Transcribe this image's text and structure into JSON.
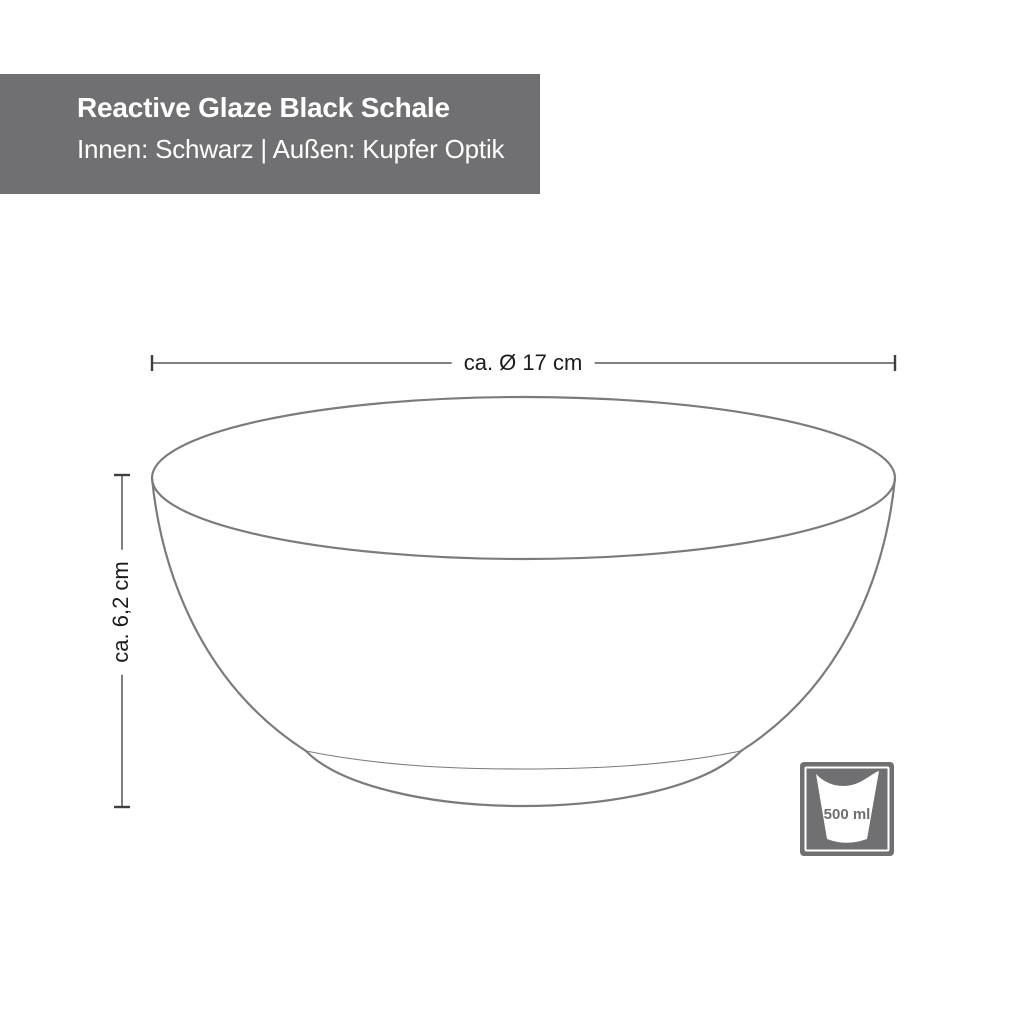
{
  "window": {
    "background": "#ffffff"
  },
  "header": {
    "title": "Reactive Glaze Black Schale",
    "subtitle": "Innen: Schwarz | Außen: Kupfer Optik",
    "bg_color": "#707072",
    "text_color": "#ffffff"
  },
  "drawing": {
    "subject": "bowl-side-view-technical-drawing",
    "outline_color": "#7b7b7f",
    "dimension_line_color": "#6f6f6f",
    "dimension_tick_color": "#3f3f3f",
    "dimension_text_color": "#1c1c1c",
    "diameter_label": "ca. Ø 17 cm",
    "height_label": "ca. 6,2 cm"
  },
  "capacity_badge": {
    "label": "500 ml",
    "bg_color": "#707072",
    "cup_color": "#ffffff",
    "label_color": "#6f6f71"
  }
}
